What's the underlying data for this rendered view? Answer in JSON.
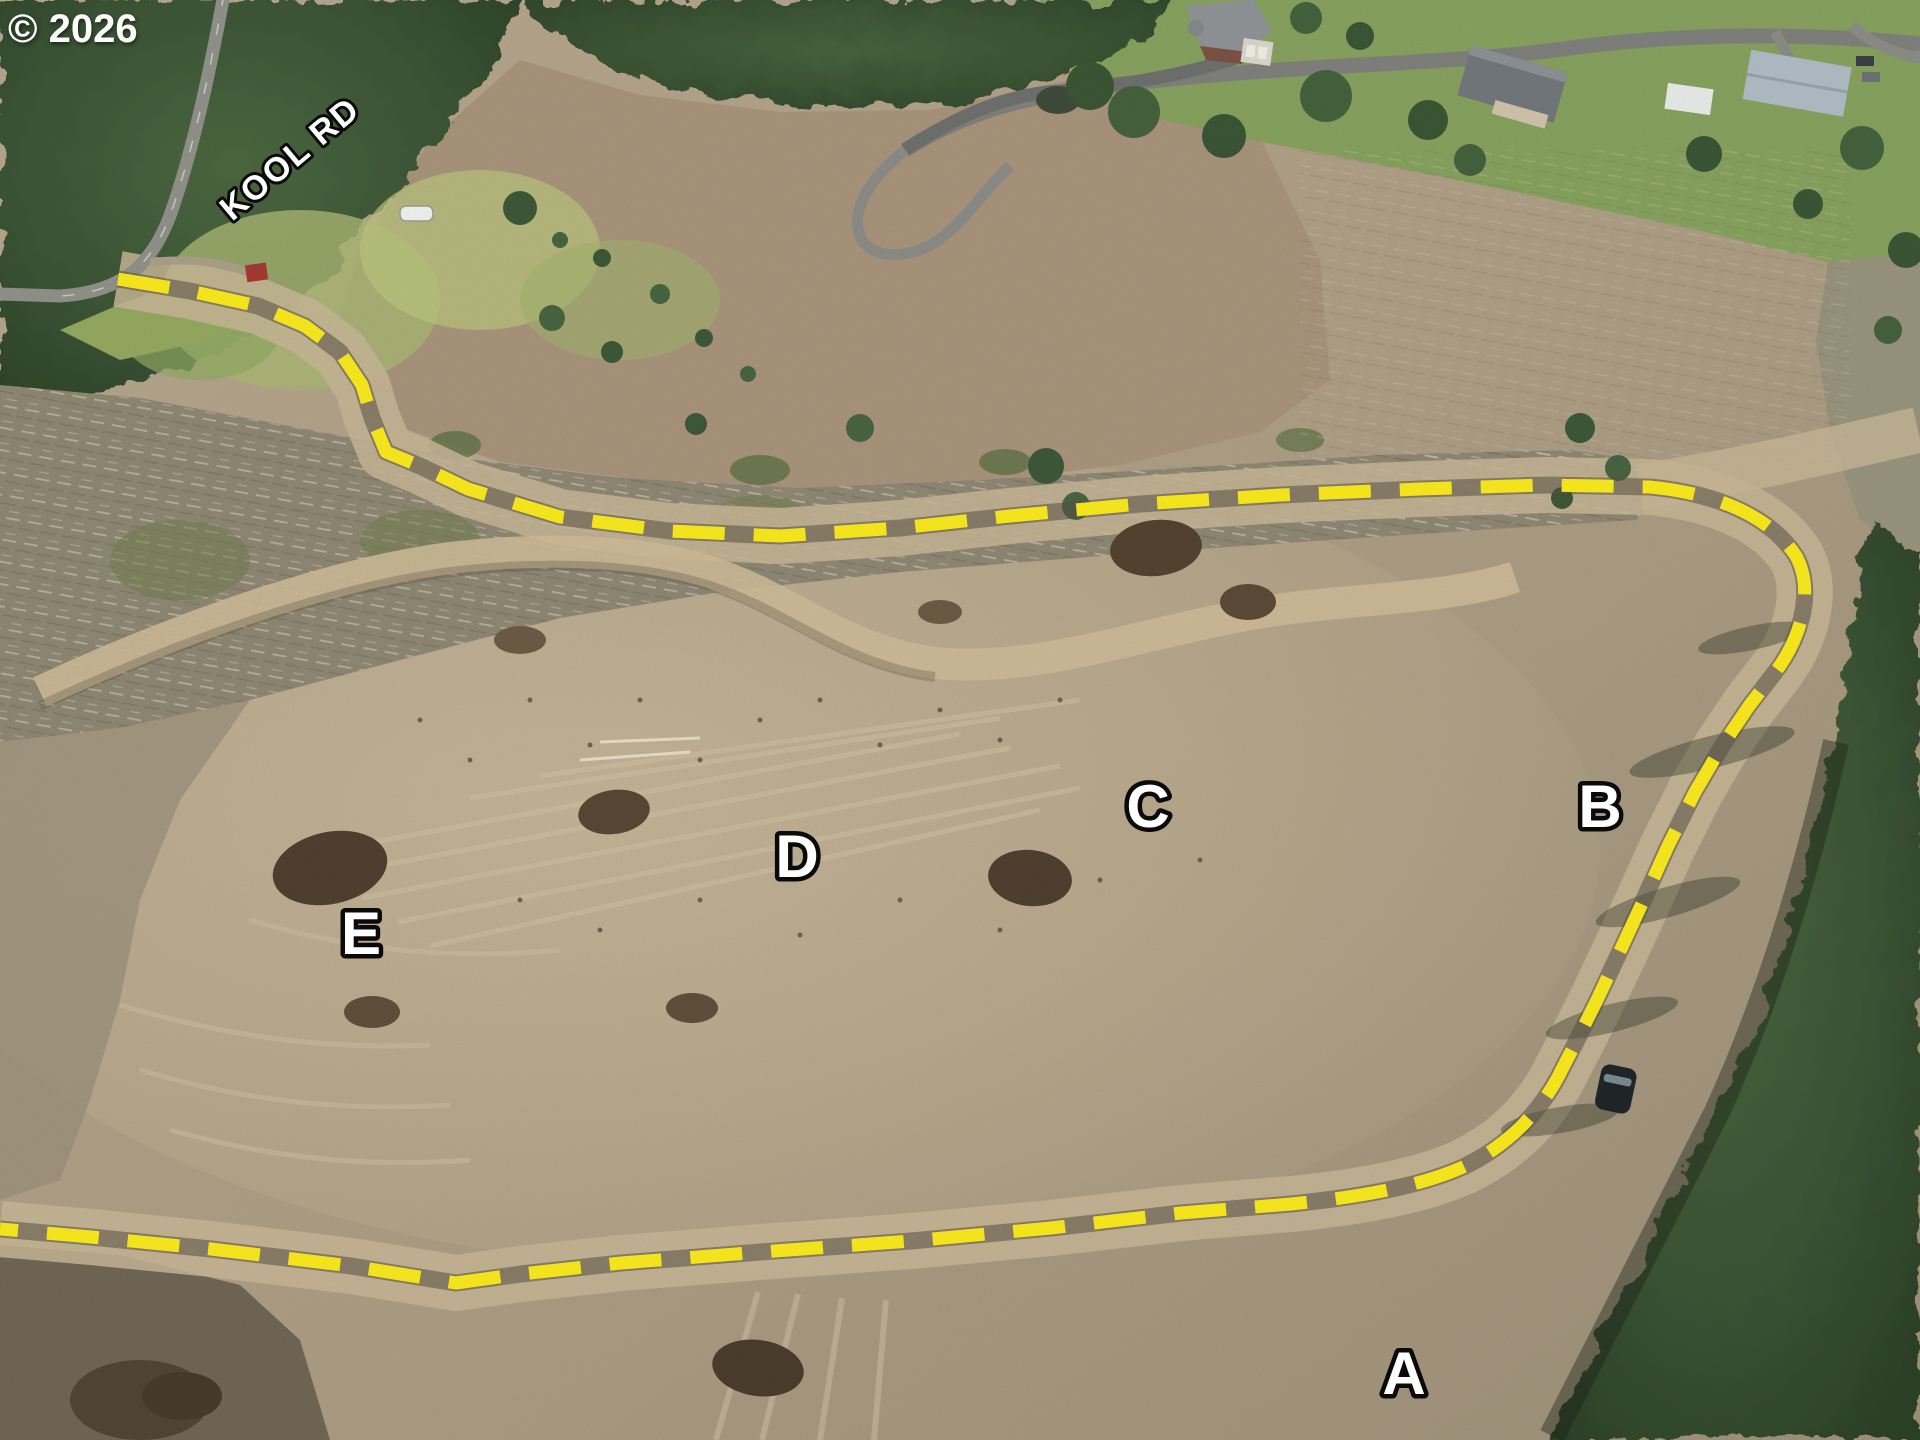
{
  "watermark": "© 2026",
  "road_label": "KOOL RD",
  "lot_labels": [
    "A",
    "B",
    "C",
    "D",
    "E"
  ],
  "boundary": {
    "color": "#f2e31c",
    "style": "dashed"
  }
}
